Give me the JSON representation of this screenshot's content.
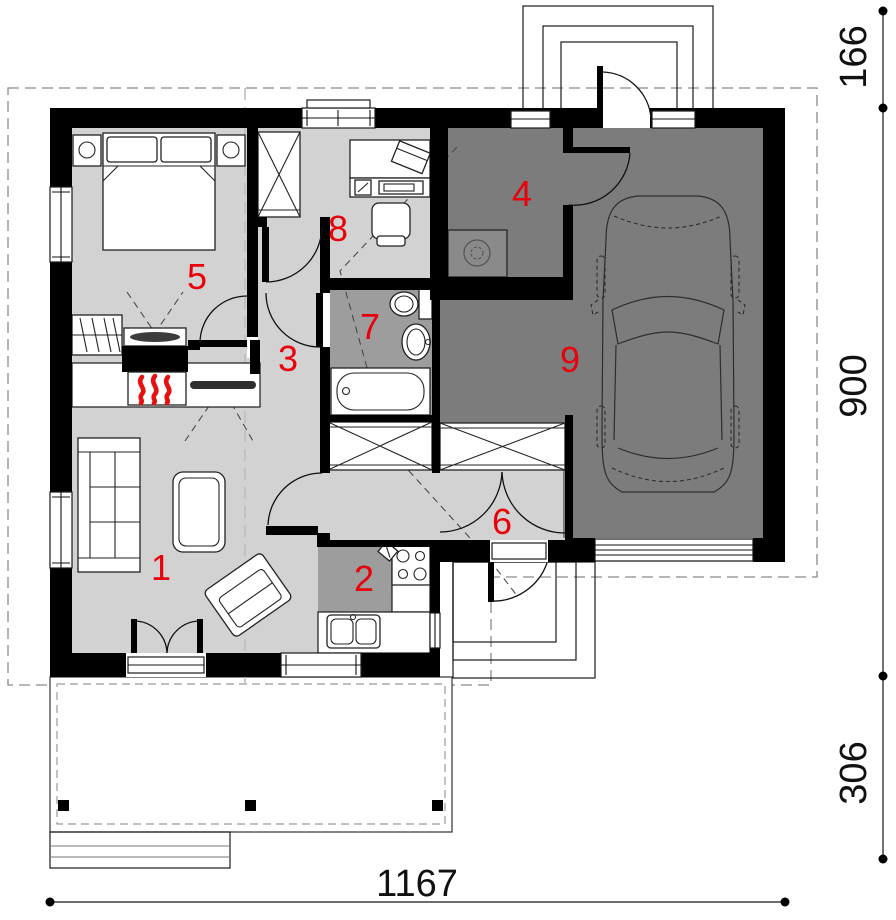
{
  "plan": {
    "type": "house-floor-plan",
    "rooms": [
      {
        "id": 1,
        "label": "1",
        "kind": "living-room"
      },
      {
        "id": 2,
        "label": "2",
        "kind": "kitchen"
      },
      {
        "id": 3,
        "label": "3",
        "kind": "corridor"
      },
      {
        "id": 4,
        "label": "4",
        "kind": "utility-room"
      },
      {
        "id": 5,
        "label": "5",
        "kind": "bedroom"
      },
      {
        "id": 6,
        "label": "6",
        "kind": "hall"
      },
      {
        "id": 7,
        "label": "7",
        "kind": "bathroom"
      },
      {
        "id": 8,
        "label": "8",
        "kind": "office"
      },
      {
        "id": 9,
        "label": "9",
        "kind": "garage"
      }
    ],
    "dimensions": {
      "right_top": "166",
      "right_middle": "900",
      "right_bottom": "306",
      "bottom": "1167"
    },
    "colors": {
      "wall": "#000000",
      "room_light": "#d2d2d2",
      "room_medium": "#9d9d9d",
      "room_dark": "#7c7c7c",
      "label_red": "#e8000a",
      "flame_red": "#e90f0f",
      "appliance_gray": "#8a8a8a"
    }
  }
}
